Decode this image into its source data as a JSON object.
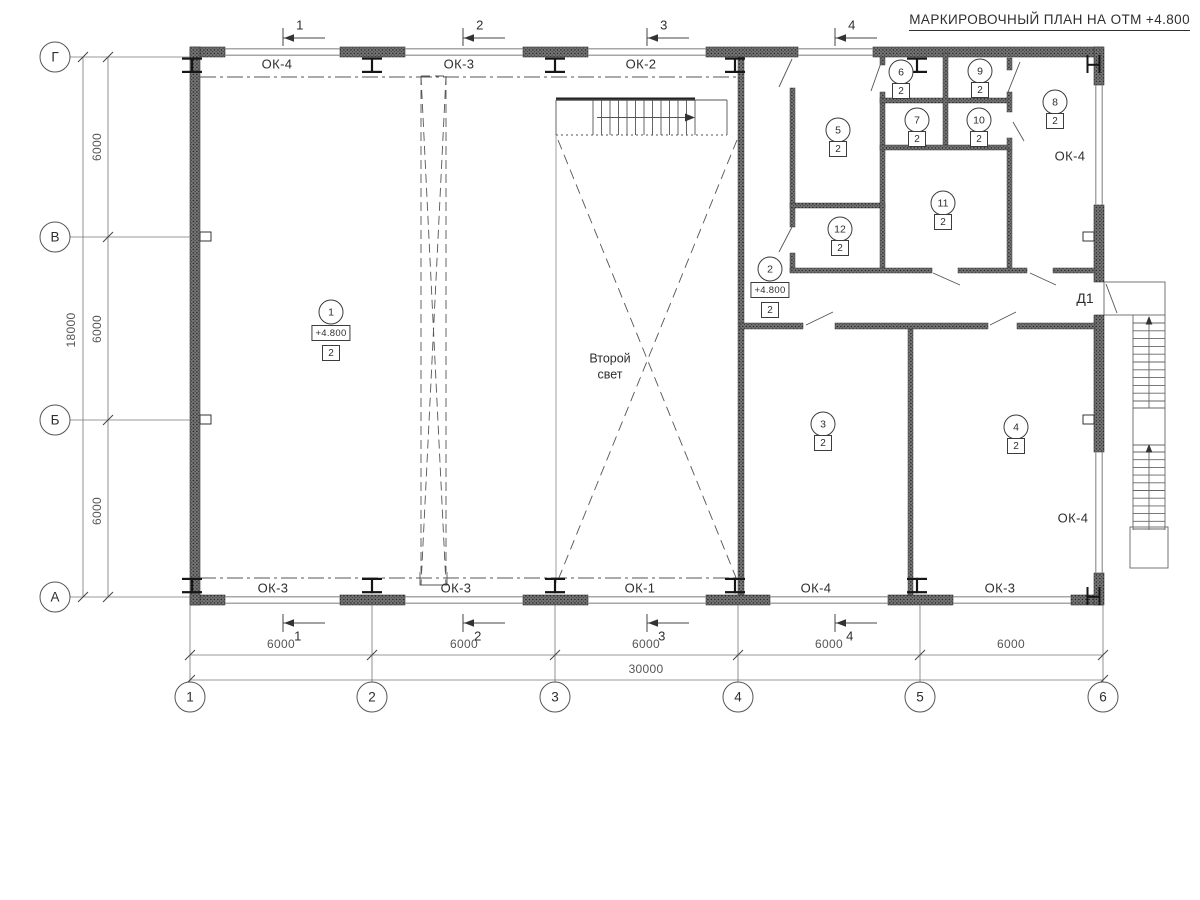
{
  "title": "МАРКИРОВОЧНЫЙ ПЛАН НА ОТМ +4.800",
  "second_light": {
    "line1": "Второй",
    "line2": "свет"
  },
  "door_label": "Д1",
  "axes": {
    "vertical": [
      {
        "label": "Г",
        "x": 55,
        "y": 57
      },
      {
        "label": "В",
        "x": 55,
        "y": 237
      },
      {
        "label": "Б",
        "x": 55,
        "y": 420
      },
      {
        "label": "А",
        "x": 55,
        "y": 597
      }
    ],
    "horizontal": [
      {
        "label": "1",
        "x": 190,
        "y": 697
      },
      {
        "label": "2",
        "x": 372,
        "y": 697
      },
      {
        "label": "3",
        "x": 555,
        "y": 697
      },
      {
        "label": "4",
        "x": 738,
        "y": 697
      },
      {
        "label": "5",
        "x": 920,
        "y": 697
      },
      {
        "label": "6",
        "x": 1103,
        "y": 697
      }
    ]
  },
  "section_marks": [
    {
      "label": "1",
      "x": 283
    },
    {
      "label": "2",
      "x": 463
    },
    {
      "label": "3",
      "x": 647
    },
    {
      "label": "4",
      "x": 835
    }
  ],
  "window_labels": [
    {
      "text": "ОК-4",
      "x": 277,
      "y": 64
    },
    {
      "text": "ОК-3",
      "x": 459,
      "y": 64
    },
    {
      "text": "ОК-2",
      "x": 641,
      "y": 64
    },
    {
      "text": "ОК-4",
      "x": 1070,
      "y": 156
    },
    {
      "text": "ОК-4",
      "x": 1073,
      "y": 518
    },
    {
      "text": "ОК-3",
      "x": 273,
      "y": 588
    },
    {
      "text": "ОК-3",
      "x": 456,
      "y": 588
    },
    {
      "text": "ОК-1",
      "x": 640,
      "y": 588
    },
    {
      "text": "ОК-4",
      "x": 816,
      "y": 588
    },
    {
      "text": "ОК-3",
      "x": 1000,
      "y": 588
    }
  ],
  "rooms": [
    {
      "num": "1",
      "type": "2",
      "elevation": "+4.800",
      "x": 331,
      "y": 312
    },
    {
      "num": "2",
      "type": "2",
      "elevation": "+4.800",
      "x": 770,
      "y": 269
    },
    {
      "num": "3",
      "type": "2",
      "x": 823,
      "y": 424
    },
    {
      "num": "4",
      "type": "2",
      "x": 1016,
      "y": 427
    },
    {
      "num": "5",
      "type": "2",
      "x": 838,
      "y": 130
    },
    {
      "num": "6",
      "type": "2",
      "x": 901,
      "y": 72
    },
    {
      "num": "7",
      "type": "2",
      "x": 917,
      "y": 120
    },
    {
      "num": "8",
      "type": "2",
      "x": 1055,
      "y": 102
    },
    {
      "num": "9",
      "type": "2",
      "x": 980,
      "y": 71
    },
    {
      "num": "10",
      "type": "2",
      "x": 979,
      "y": 120
    },
    {
      "num": "11",
      "type": "2",
      "x": 943,
      "y": 203
    },
    {
      "num": "12",
      "type": "2",
      "x": 840,
      "y": 229
    }
  ],
  "dimensions": {
    "bottom_segments": [
      {
        "text": "6000",
        "x": 281
      },
      {
        "text": "6000",
        "x": 464
      },
      {
        "text": "6000",
        "x": 646
      },
      {
        "text": "6000",
        "x": 829
      },
      {
        "text": "6000",
        "x": 1011
      }
    ],
    "bottom_total": {
      "text": "30000",
      "x": 646,
      "y": 669
    },
    "left_segments": [
      {
        "text": "6000",
        "y": 147
      },
      {
        "text": "6000",
        "y": 329
      },
      {
        "text": "6000",
        "y": 511
      }
    ],
    "left_total": {
      "text": "18000",
      "x": 71,
      "y": 330
    }
  },
  "colors": {
    "wall": "#3f3f3f",
    "line": "#6b6b6b",
    "text": "#2e2e2e"
  }
}
